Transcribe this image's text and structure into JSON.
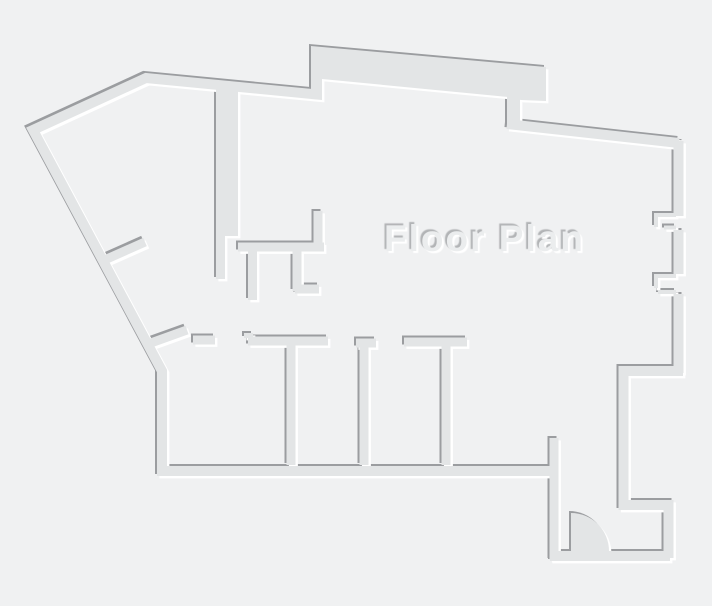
{
  "title": "Floor Plan",
  "canvas": {
    "width": 712,
    "height": 606
  },
  "colors": {
    "background": "#f0f1f2",
    "wall_fill": "#e3e5e6",
    "wall_shadow": "#9b9da0",
    "wall_highlight": "#ffffff",
    "title_fill": "#ebedee",
    "title_shadow_dark": "#b2b4b6",
    "title_shadow_light": "#ffffff"
  },
  "annotations": {
    "door_swing": "quarter-circle door arc at bottom-right entry",
    "wall_openings": "two jamb-marked openings on right exterior wall",
    "style": "embossed monochrome floor plan, light source top-left"
  }
}
